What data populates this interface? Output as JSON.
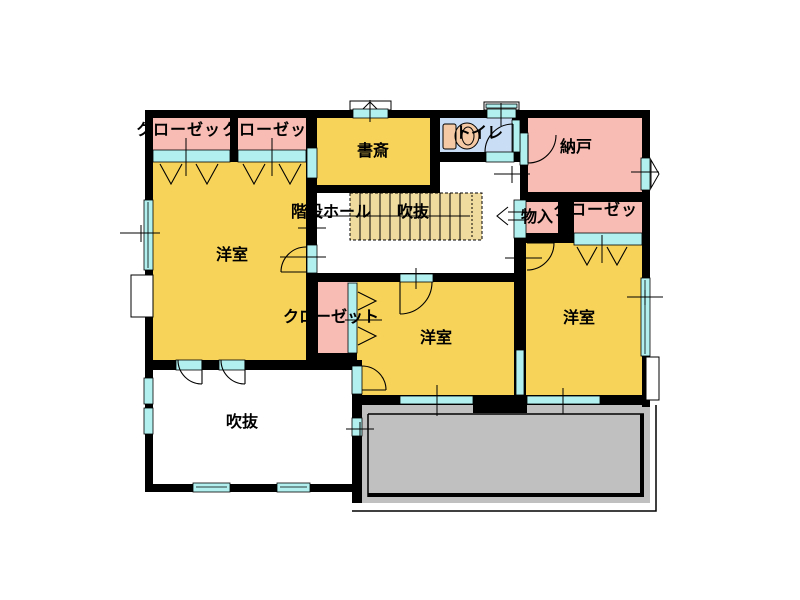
{
  "figure": {
    "type": "floor-plan-2f",
    "width_px": 800,
    "height_px": 600
  },
  "colors": {
    "bg": "#FFFFFF",
    "text": "#000000",
    "wall": "#000000",
    "room_yellow": "#F7D35A",
    "room_pink": "#F9BCB4",
    "room_blue": "#C9DDF5",
    "window_cyan": "#B2F0F0",
    "stair_fill": "#EFDB9E",
    "balcony_gray": "#C0C0C0",
    "fixture_tan": "#F4C9A4"
  },
  "labels": {
    "closet_nw1": "クローゼッ",
    "closet_nw2": "クローゼッ",
    "study": "書斎",
    "toilet": "トイレ",
    "storeroom": "納戸",
    "stair_hall": "階段ホール",
    "stair_void": "吹抜",
    "storage": "物入",
    "closet_ne": "クローゼッ",
    "closet_center": "クローゼット",
    "bedroom_west": "洋室",
    "bedroom_center": "洋室",
    "bedroom_east": "洋室",
    "void": "吹抜"
  }
}
